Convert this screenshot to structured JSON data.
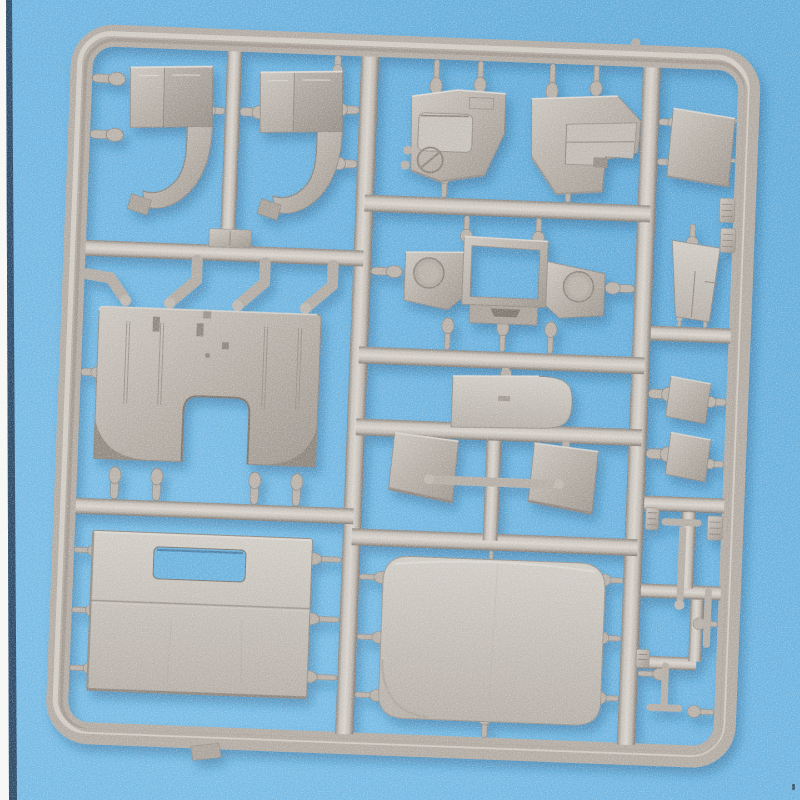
{
  "scene": {
    "type": "photograph",
    "subject": "injection-molded model kit sprue of light gray plastic parts on a blue backdrop",
    "background": {
      "base": "#6fb5e1",
      "light_patch": "#82c4eb",
      "dark_patch": "#5aa6d5",
      "left_edge_white": "#f6f7f5",
      "left_edge_dark": "#2b4a68",
      "corner_mark": "#34566f"
    },
    "plastic": {
      "base": "#b4ada5",
      "highlight": "#d7d2cb",
      "midtone": "#c6c0b9",
      "shadow_edge": "#8a837b",
      "deep_shadow": "#7e766e",
      "cast_shadow": "#1c4f7c"
    },
    "sprue": {
      "frame": "rounded-rectangle runner frame, tilted slightly clockwise",
      "parts": [
        {
          "name": "fender-arch-part-a"
        },
        {
          "name": "fender-arch-part-b"
        },
        {
          "name": "cab-side-panel-left"
        },
        {
          "name": "cab-side-panel-right"
        },
        {
          "name": "side-wall-square-panel"
        },
        {
          "name": "windshield-axle-frame-part"
        },
        {
          "name": "wedge-panel"
        },
        {
          "name": "rounded-corner-plate"
        },
        {
          "name": "door-panel-left"
        },
        {
          "name": "door-panel-right"
        },
        {
          "name": "small-box-upper"
        },
        {
          "name": "small-box-lower"
        },
        {
          "name": "cab-floor-plate-with-cutout"
        },
        {
          "name": "cargo-box-panel-with-slot"
        },
        {
          "name": "cab-roof-panel"
        },
        {
          "name": "assorted-small-rods-and-clips"
        }
      ]
    }
  }
}
